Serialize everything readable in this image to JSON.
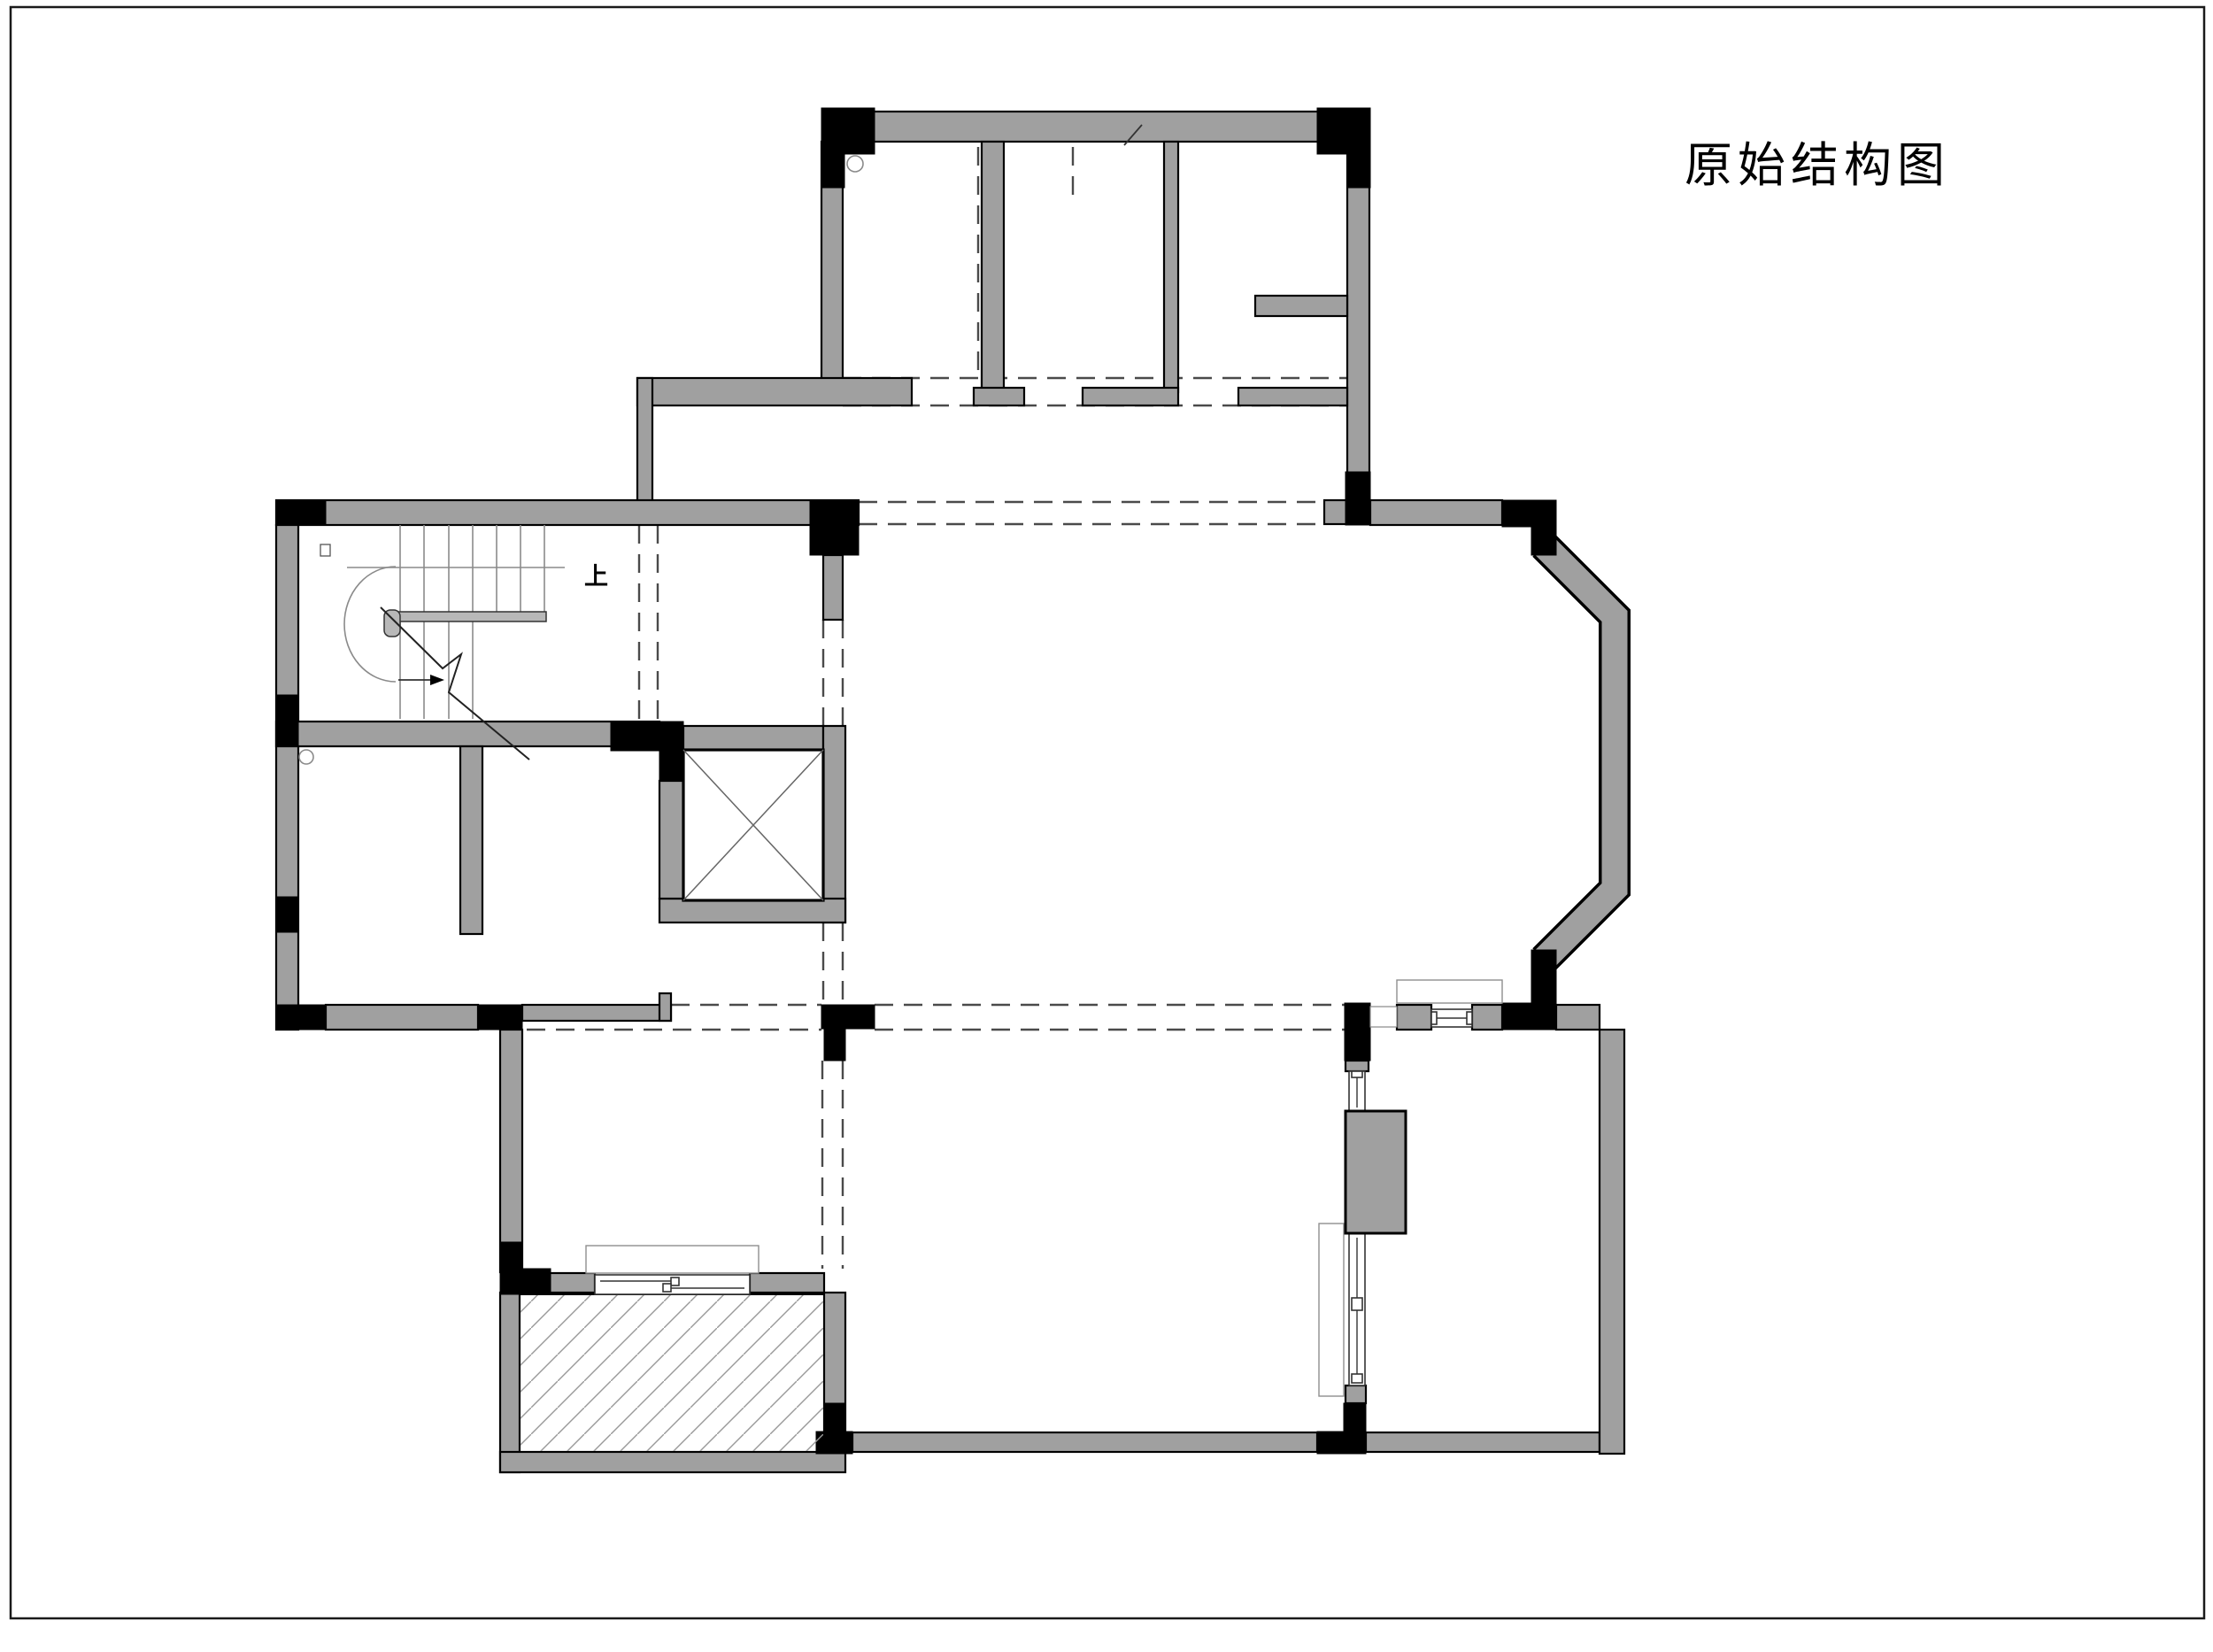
{
  "page": {
    "title": "原始结构图",
    "background": "#ffffff",
    "border_color": "#1a1a1a"
  },
  "plan": {
    "stair_up_label": "上",
    "symbols": {
      "elevator_shaft": "crossed-box",
      "balcony_floor": "diagonal-hatch",
      "beams": "dashed-lines",
      "columns": "solid-black-rectangles",
      "walls": "gray-filled-outlined"
    }
  },
  "colors": {
    "wall_fill": "#a0a0a0",
    "column_fill": "#000000",
    "outline": "#000000",
    "beam_dash": "#4a4a4a",
    "hatch_line": "#999999",
    "stair_line": "#8a8a8a",
    "thin_line": "#333333",
    "sill_line": "#8f8f8f",
    "page_bg": "#ffffff",
    "border_color": "#1a1a1a"
  }
}
